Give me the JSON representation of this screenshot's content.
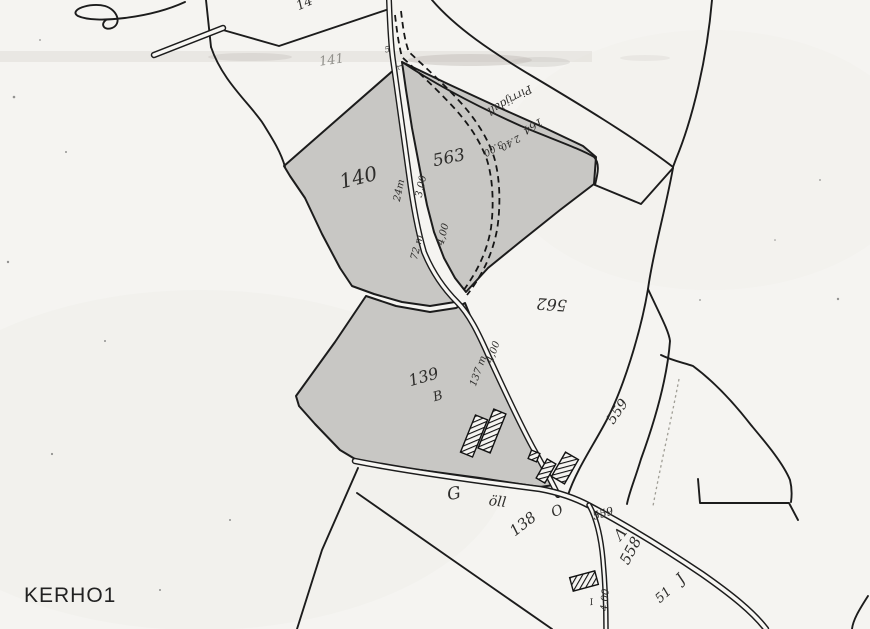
{
  "corner_label": "KERHO1",
  "labels": {
    "parcel_141": "141",
    "parcel_top_partial": "14",
    "parcel_140": "140",
    "parcel_563": "563",
    "parcel_562": "562",
    "parcel_139": "139",
    "parcel_139_letter": "B",
    "parcel_559": "559",
    "parcel_558": "558",
    "parcel_51": "51",
    "parcel_138": "138",
    "parcel_138_letter": "O",
    "road_parcel_559": "559"
  },
  "measurements": {
    "m24": "24m",
    "w300": "3,00",
    "m72": "72 m",
    "w400_upper": "4,00",
    "m137": "137 m",
    "w400_mid": "4,00",
    "w300_path": "3.00",
    "w240_path": "2.40",
    "w400_bottom": "4.00",
    "mark_I": "I",
    "mark_5": "5",
    "mark_L": "L"
  },
  "road_names": {
    "old_road": "Pirrijdall",
    "old_road_number": "164",
    "street_g": "G",
    "street_oll": "öll"
  },
  "script_marks": {
    "mark_558": "Λ",
    "mark_51": "J"
  },
  "colors": {
    "paper": "#f5f4f1",
    "ink": "#1c1c1c",
    "parcel_shade": "#c8c7c4",
    "faint_ink": "#908f8a"
  }
}
